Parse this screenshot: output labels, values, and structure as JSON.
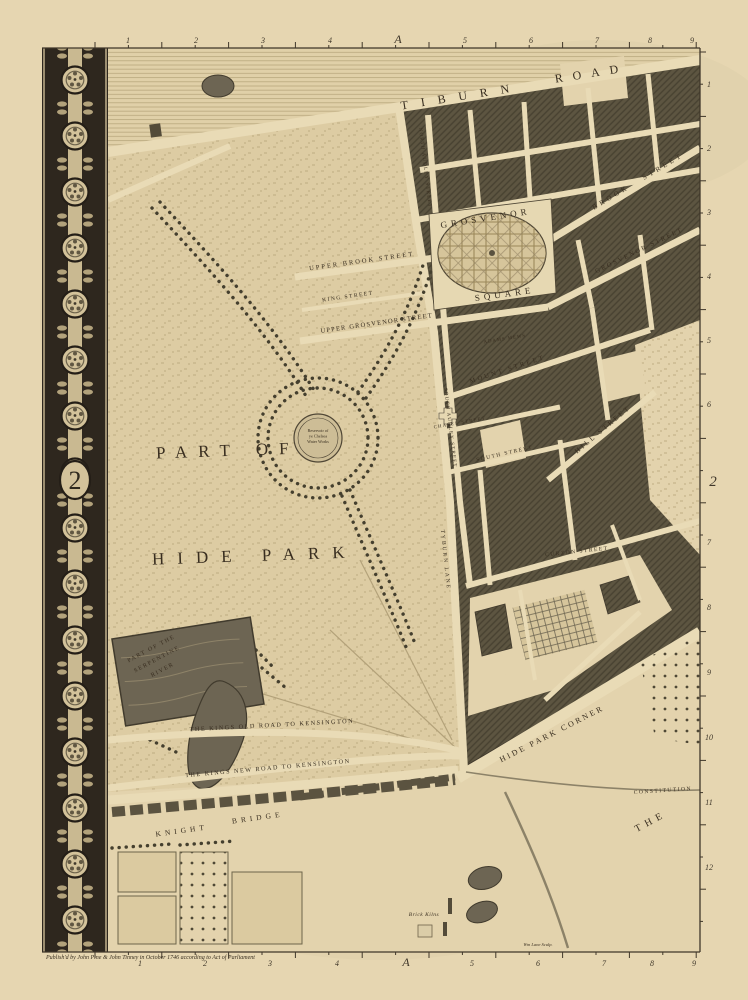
{
  "plate": {
    "sheet_number": "2",
    "grid_letter": "A",
    "map_title_region": "Hyde Park, Grosvenor Square and Hyde Park Corner"
  },
  "rulers": {
    "top": [
      {
        "t": "1",
        "p": 128
      },
      {
        "t": "2",
        "p": 196
      },
      {
        "t": "3",
        "p": 263
      },
      {
        "t": "4",
        "p": 330
      },
      {
        "t": "A",
        "p": 398
      },
      {
        "t": "5",
        "p": 465
      },
      {
        "t": "6",
        "p": 531
      },
      {
        "t": "7",
        "p": 597
      },
      {
        "t": "8",
        "p": 650
      },
      {
        "t": "9",
        "p": 692
      }
    ],
    "bottom": [
      {
        "t": "1",
        "p": 140
      },
      {
        "t": "2",
        "p": 205
      },
      {
        "t": "3",
        "p": 270
      },
      {
        "t": "4",
        "p": 337
      },
      {
        "t": "A",
        "p": 406
      },
      {
        "t": "5",
        "p": 472
      },
      {
        "t": "6",
        "p": 538
      },
      {
        "t": "7",
        "p": 604
      },
      {
        "t": "8",
        "p": 652
      },
      {
        "t": "9",
        "p": 694
      }
    ],
    "right": [
      {
        "t": "1",
        "p": 84
      },
      {
        "t": "2",
        "p": 148
      },
      {
        "t": "3",
        "p": 212
      },
      {
        "t": "4",
        "p": 276
      },
      {
        "t": "5",
        "p": 340
      },
      {
        "t": "6",
        "p": 404
      },
      {
        "t": "7",
        "p": 542
      },
      {
        "t": "8",
        "p": 607
      },
      {
        "t": "9",
        "p": 672
      },
      {
        "t": "10",
        "p": 737
      },
      {
        "t": "11",
        "p": 802
      },
      {
        "t": "12",
        "p": 867
      }
    ]
  },
  "map_labels": [
    {
      "id": "tiburn-road-1",
      "text": "TIBURN",
      "x": 462,
      "y": 100,
      "rot": -9,
      "fs": 12,
      "ls": 13
    },
    {
      "id": "tiburn-road-2",
      "text": "ROAD",
      "x": 592,
      "y": 77,
      "rot": -9,
      "fs": 12,
      "ls": 10
    },
    {
      "id": "upper-brook-street",
      "text": "UPPER BROOK STREET",
      "x": 362,
      "y": 263,
      "rot": -8,
      "fs": 6.5,
      "ls": 2
    },
    {
      "id": "king-street",
      "text": "KING STREET",
      "x": 348,
      "y": 298,
      "rot": -8,
      "fs": 5.5,
      "ls": 1.5
    },
    {
      "id": "upper-grosvenor-street",
      "text": "UPPER GROSVENOR STREET",
      "x": 377,
      "y": 325,
      "rot": -8,
      "fs": 6.5,
      "ls": 1.2
    },
    {
      "id": "grosvenor",
      "text": "GROSVENOR",
      "x": 486,
      "y": 221,
      "rot": -9,
      "fs": 9,
      "ls": 4
    },
    {
      "id": "square",
      "text": "SQUARE",
      "x": 505,
      "y": 297,
      "rot": -8,
      "fs": 9,
      "ls": 4
    },
    {
      "id": "brook-street-1",
      "text": "BROOK",
      "x": 612,
      "y": 199,
      "rot": -31,
      "fs": 7,
      "ls": 3.5
    },
    {
      "id": "brook-street-2",
      "text": "STREET",
      "x": 664,
      "y": 168,
      "rot": -31,
      "fs": 7,
      "ls": 3.5
    },
    {
      "id": "grosvenor-street",
      "text": "GROSVENOR STREET",
      "x": 640,
      "y": 252,
      "rot": -26,
      "fs": 6.5,
      "ls": 2
    },
    {
      "id": "north-audley-street",
      "text": "NORTH AUDLEY STREET",
      "x": 424,
      "y": 168,
      "rot": 83,
      "fs": 5,
      "ls": 1.2
    },
    {
      "id": "south-audley-street",
      "text": "SOUTH AUDLEY STREET",
      "x": 449,
      "y": 428,
      "rot": 83,
      "fs": 5,
      "ls": 1.2
    },
    {
      "id": "tyburn-lane",
      "text": "TYBURN LANE",
      "x": 444,
      "y": 560,
      "rot": 84,
      "fs": 5.5,
      "ls": 2
    },
    {
      "id": "mount-street",
      "text": "MOUNT STREET",
      "x": 508,
      "y": 371,
      "rot": -18,
      "fs": 6.5,
      "ls": 2.5
    },
    {
      "id": "adams-mews",
      "text": "ADAMS MEWS",
      "x": 505,
      "y": 340,
      "rot": -9,
      "fs": 4.8,
      "ls": 1
    },
    {
      "id": "south-street",
      "text": "SOUTH STREET",
      "x": 505,
      "y": 455,
      "rot": -13,
      "fs": 5.5,
      "ls": 1.5
    },
    {
      "id": "chapel-street",
      "text": "CHAPEL STREET",
      "x": 460,
      "y": 424,
      "rot": -10,
      "fs": 4.8,
      "ls": 1.2
    },
    {
      "id": "hill-street",
      "text": "HILL STREET",
      "x": 604,
      "y": 431,
      "rot": -40,
      "fs": 7,
      "ls": 2.5
    },
    {
      "id": "curzon-street",
      "text": "CURZON STREET",
      "x": 577,
      "y": 553,
      "rot": -6,
      "fs": 5.5,
      "ls": 1.5
    },
    {
      "id": "part-of",
      "text": "PART OF",
      "x": 228,
      "y": 456,
      "rot": -2,
      "fs": 17,
      "ls": 11
    },
    {
      "id": "hide-park",
      "text": "HIDE PARK",
      "x": 255,
      "y": 561,
      "rot": -2,
      "fs": 17,
      "ls": 13
    },
    {
      "id": "serpentine",
      "lines": [
        "PART OF THE",
        "SERPENTINE",
        "RIVER"
      ],
      "x": 152,
      "y": 650,
      "rot": -28,
      "fs": 6,
      "lh": 12,
      "ls": 1.5
    },
    {
      "id": "reservoir-label",
      "lines": [
        "Reservoir of",
        "ye Chelsea",
        "Water Works"
      ],
      "x": 318,
      "y": 432,
      "rot": 0,
      "fs": 4.2,
      "lh": 5.6,
      "ls": 0
    },
    {
      "id": "kings-old-road",
      "text": "THE KINGS OLD ROAD TO KENSINGTON",
      "x": 272,
      "y": 727,
      "rot": -3,
      "fs": 6.2,
      "ls": 1.5
    },
    {
      "id": "kings-new-road",
      "text": "THE KINGS NEW ROAD TO KENSINGTON",
      "x": 268,
      "y": 770,
      "rot": -5,
      "fs": 6.2,
      "ls": 1.5
    },
    {
      "id": "knight",
      "text": "KNIGHT",
      "x": 182,
      "y": 833,
      "rot": -8,
      "fs": 7.5,
      "ls": 4
    },
    {
      "id": "bridge",
      "text": "BRIDGE",
      "x": 258,
      "y": 820,
      "rot": -8,
      "fs": 7.5,
      "ls": 4
    },
    {
      "id": "hide-park-corner",
      "text": "HIDE PARK CORNER",
      "x": 553,
      "y": 736,
      "rot": -27,
      "fs": 8,
      "ls": 2.5
    },
    {
      "id": "constitution",
      "text": "CONSTITUTION",
      "x": 663,
      "y": 792,
      "rot": -4,
      "fs": 5.5,
      "ls": 1.5
    },
    {
      "id": "the-green-park",
      "text": "THE",
      "x": 652,
      "y": 824,
      "rot": -28,
      "fs": 10,
      "ls": 5
    },
    {
      "id": "brick-kilns",
      "text": "Brick Kilns",
      "x": 424,
      "y": 916,
      "rot": 0,
      "fs": 5.5,
      "ls": 0.5,
      "italic": true
    },
    {
      "id": "imprint",
      "text": "Publish'd by John Pine & John Tinney in October 1746 according to Act of Parliament",
      "x": 46,
      "y": 959,
      "rot": 0,
      "fs": 6,
      "ls": 0,
      "italic": true,
      "anchor": "start"
    },
    {
      "id": "engraver-mark",
      "text": "Wm Lane Sculp.",
      "x": 538,
      "y": 946,
      "rot": 0,
      "fs": 4.5,
      "ls": 0,
      "italic": true
    }
  ],
  "colors": {
    "paper": "#e9dab5",
    "map_base": "#e6d6b0",
    "park": "#e0cfa6",
    "ink": "#33291c",
    "block": "#59523f",
    "street": "#ecdfba",
    "water": "#6a6252",
    "border_dark": "#27211a",
    "border_light": "#d5c59c",
    "hatch_line": "#b9a87e"
  }
}
